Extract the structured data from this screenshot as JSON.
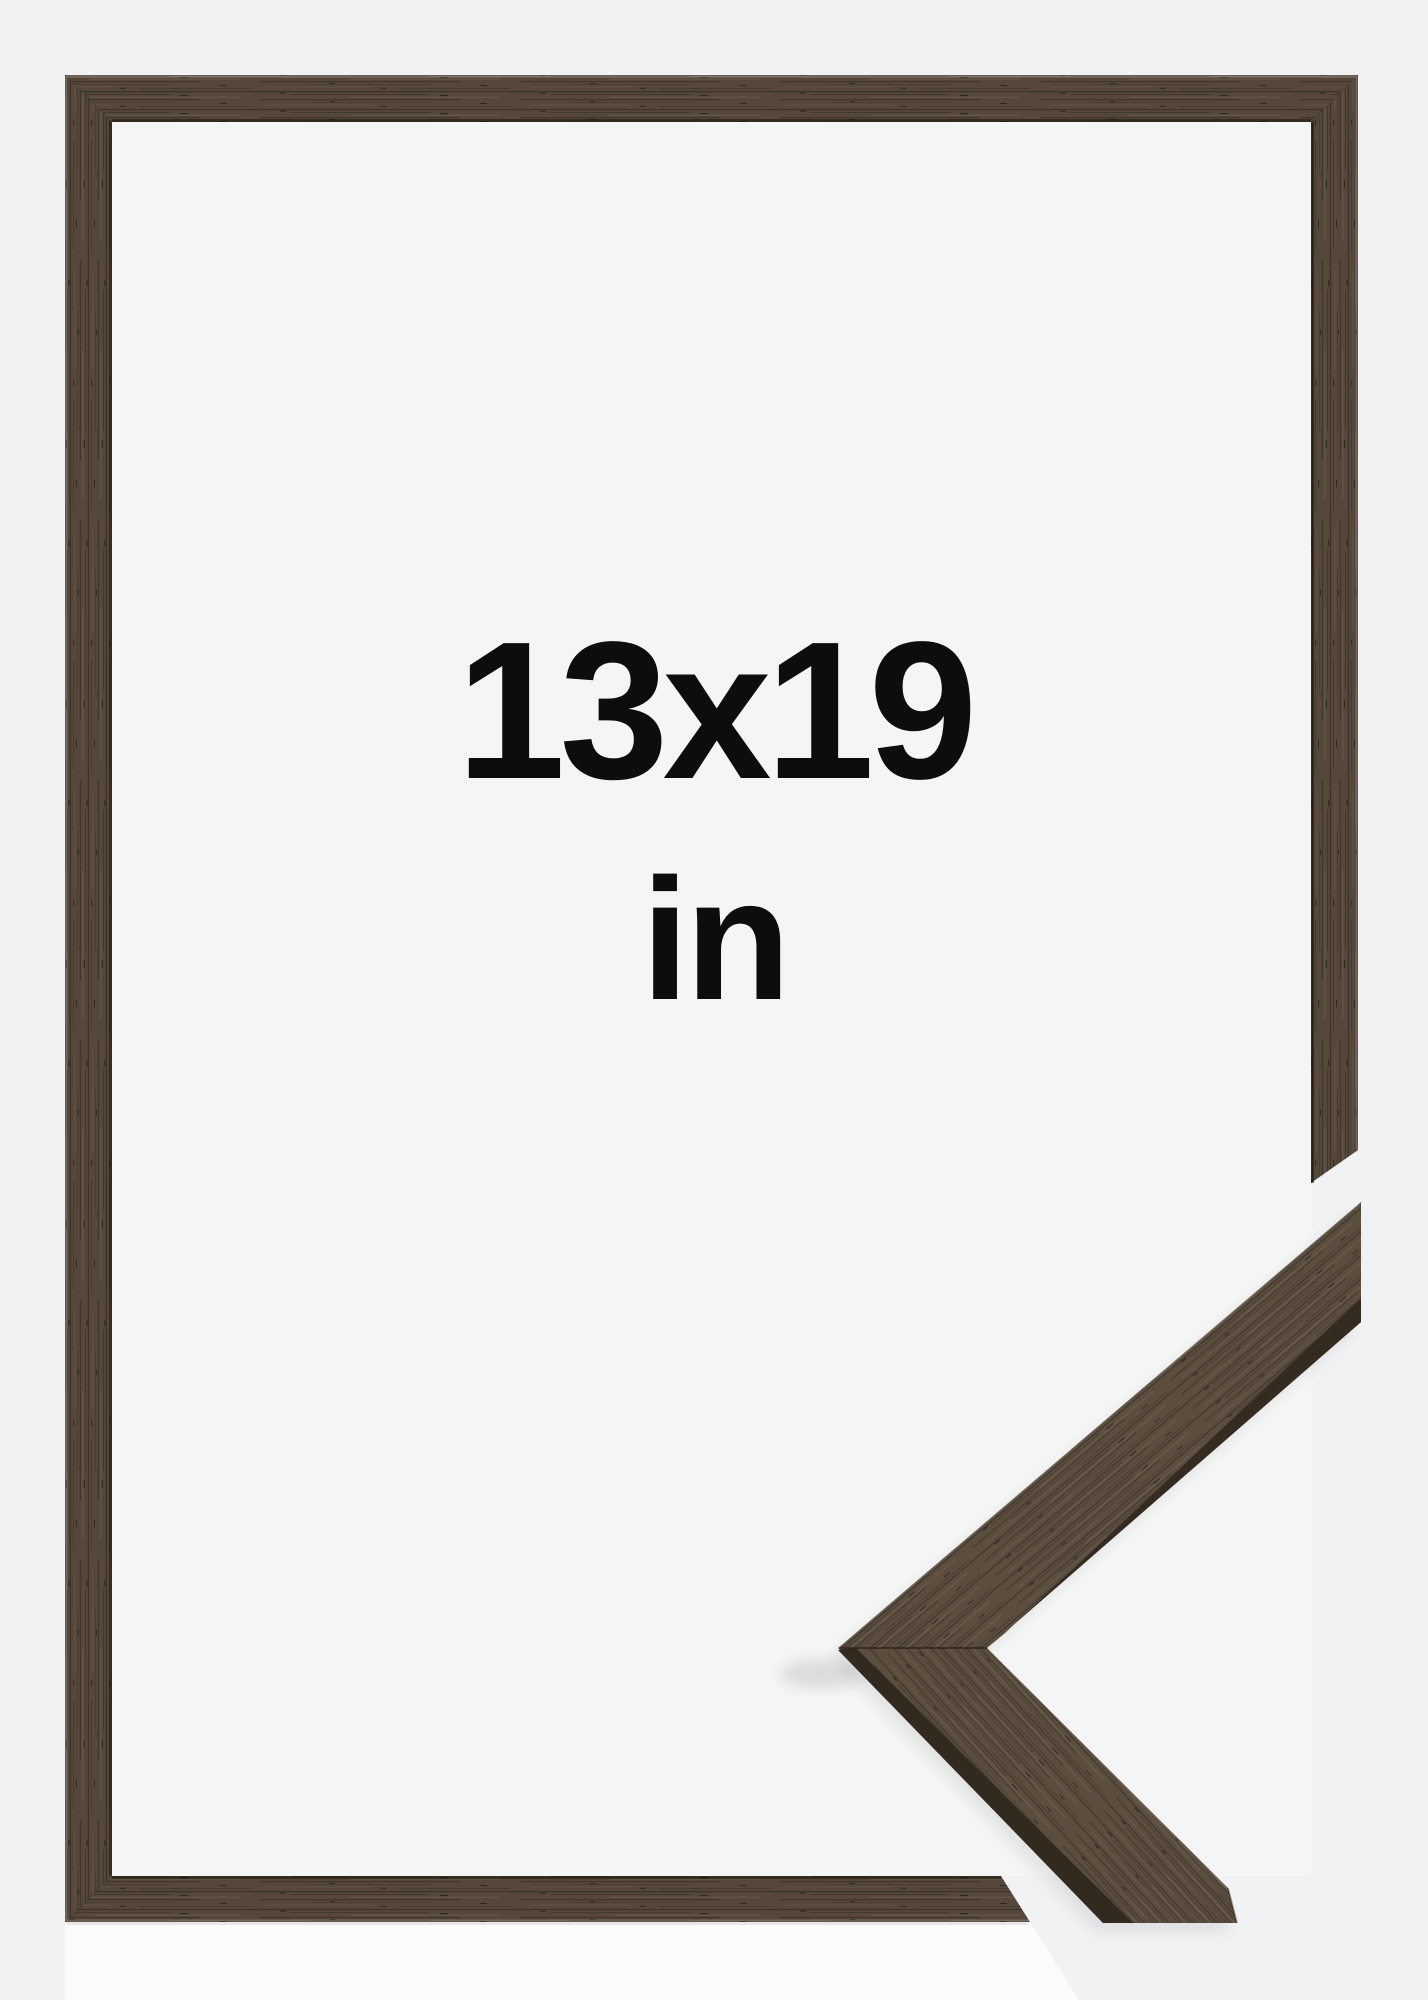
{
  "product_image": {
    "size_label": "13x19",
    "unit_label": "in"
  },
  "colors": {
    "page_background": "#f1f2f3",
    "photo_background": "#fbfbfb",
    "inner_background": "#f4f5f5",
    "wood_base": "#55483a",
    "wood_sample_base": "#5b4e3f",
    "wood_side_face": "#32291f",
    "wood_inner_edge": "#1c150f",
    "label_text": "#0d0d0d"
  }
}
